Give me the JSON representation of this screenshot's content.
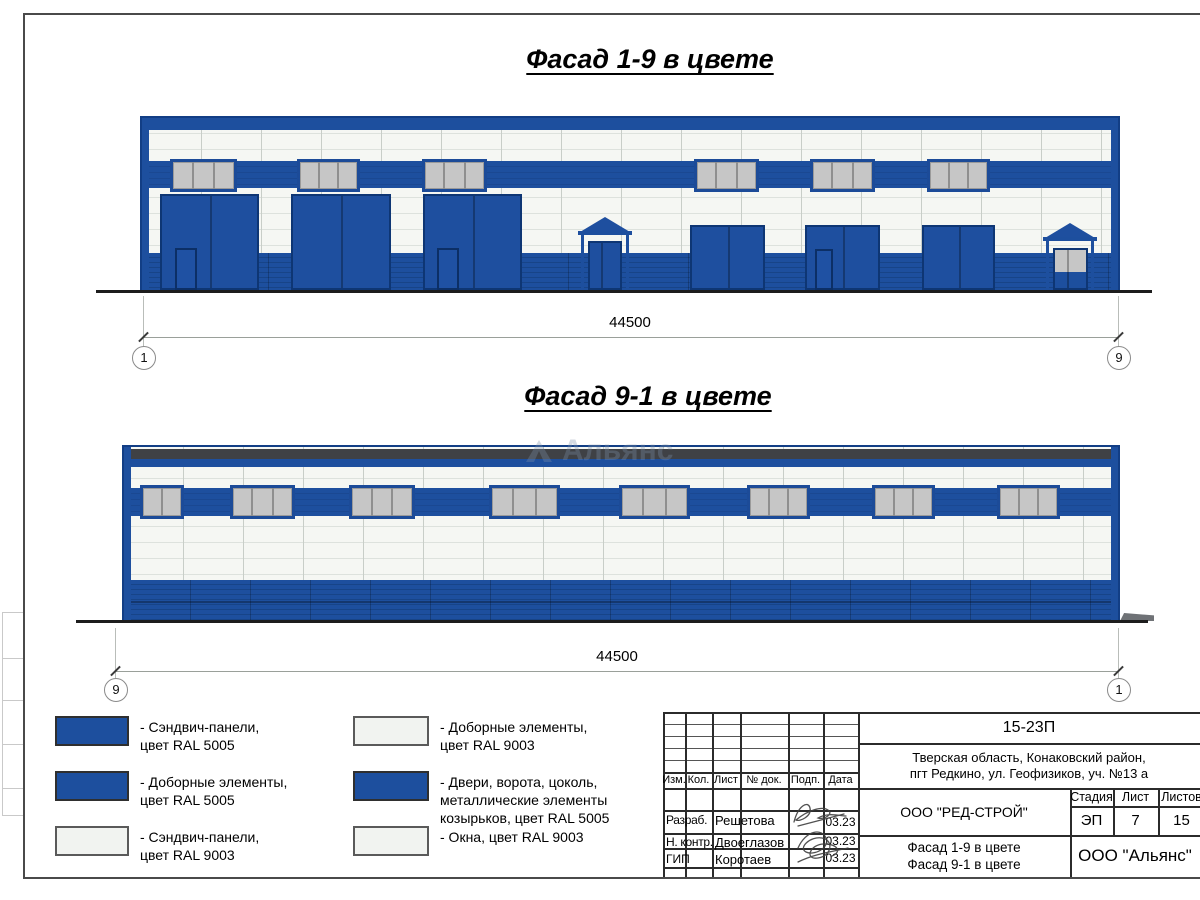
{
  "sheet": {
    "watermark": "Альянс"
  },
  "facade1": {
    "title": "Фасад 1-9 в цвете",
    "dimension": "44500",
    "axis_left": "1",
    "axis_right": "9"
  },
  "facade2": {
    "title": "Фасад 9-1 в цвете",
    "dimension": "44500",
    "axis_left": "9",
    "axis_right": "1"
  },
  "legend": {
    "items": [
      {
        "swatch": "blue",
        "label": "- Сэндвич-панели,\nцвет RAL 5005"
      },
      {
        "swatch": "blue",
        "label": "- Доборные элементы,\nцвет RAL 5005"
      },
      {
        "swatch": "white",
        "label": "- Сэндвич-панели,\nцвет RAL 9003"
      },
      {
        "swatch": "white",
        "label": "- Доборные элементы,\nцвет RAL 9003"
      },
      {
        "swatch": "blue",
        "label": "- Двери, ворота, цоколь,\nметаллические элементы\nкозырьков, цвет RAL 5005"
      },
      {
        "swatch": "white",
        "label": "- Окна, цвет RAL 9003"
      }
    ]
  },
  "colors": {
    "ral5005": "#1d4f9e",
    "ral9003": "#f3f5f2",
    "window_gray": "#c6c6c6",
    "parapet": "#3f4145"
  },
  "titleblock": {
    "doc_code": "15-23П",
    "address": "Тверская область, Конаковский район,\nпгт Редкино, ул. Геофизиков, уч. №13 а",
    "columns": {
      "izm": "Изм.",
      "kol": "Кол.",
      "list": "Лист",
      "doc": "№ док.",
      "podp": "Подп.",
      "data": "Дата"
    },
    "rows": [
      {
        "role": "Разраб.",
        "name": "Решетова",
        "date": "03.23"
      },
      {
        "role": "Н. контр.",
        "name": "Двоеглазов",
        "date": "03.23"
      },
      {
        "role": "ГИП",
        "name": "Коротаев",
        "date": "03.23"
      }
    ],
    "company": "ООО \"РЕД-СТРОЙ\"",
    "sheet_title": "Фасад 1-9 в цвете\nФасад 9-1 в цвете",
    "stage_label": "Стадия",
    "list_label": "Лист",
    "listov_label": "Листов",
    "stage": "ЭП",
    "list": "7",
    "listov": "15",
    "org": "ООО \"Альянс\""
  }
}
